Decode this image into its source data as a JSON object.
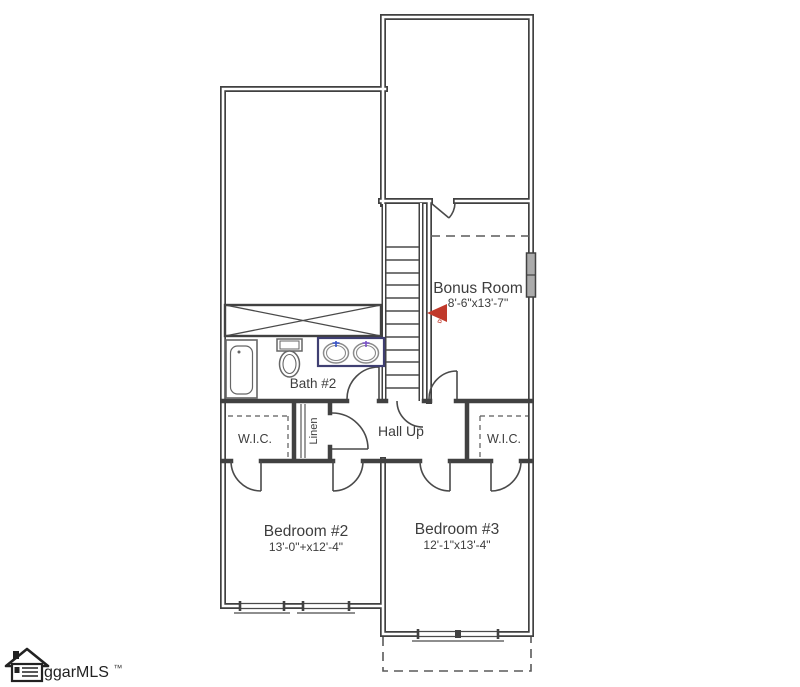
{
  "rooms": {
    "bonus_room": {
      "label": "Bonus Room",
      "dimensions": "8'-6\"x13'-7\""
    },
    "bath_2": {
      "label": "Bath #2"
    },
    "hall": {
      "label": "Hall Up"
    },
    "wic_left": {
      "label": "W.I.C."
    },
    "wic_right": {
      "label": "W.I.C."
    },
    "linen": {
      "label": "Linen"
    },
    "bedroom_2": {
      "label": "Bedroom #2",
      "dimensions": "13'-0\"+x12'-4\""
    },
    "bedroom_3": {
      "label": "Bedroom #3",
      "dimensions": "12'-1\"x13'-4\""
    }
  },
  "marker": {
    "label": "DATA",
    "color": "#c0392b"
  },
  "logo": {
    "text": "ggarMLS",
    "trademark": "™"
  },
  "colors": {
    "background": "#ffffff",
    "wall": "#414141",
    "line": "#4a4a4a",
    "text": "#3d3d3d",
    "fixture_outline": "#666666",
    "vanity_outline": "#3f3f72",
    "faucet_left_blue": "#3753c8",
    "faucet_right_purple": "#7a52c8",
    "window_fill": "#ababab"
  }
}
